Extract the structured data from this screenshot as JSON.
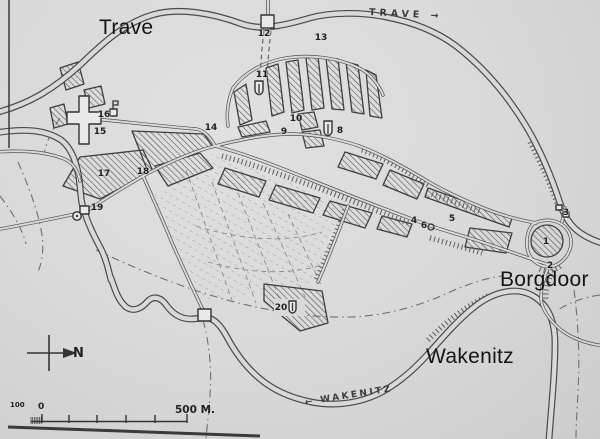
{
  "map": {
    "region_labels": [
      {
        "name": "trave",
        "text": "Trave"
      },
      {
        "name": "borgdoor",
        "text": "Borgdoor"
      },
      {
        "name": "wakenitz",
        "text": "Wakenitz"
      }
    ],
    "river_labels": [
      {
        "name": "trave-river",
        "text": "TRAVE →"
      },
      {
        "name": "wakenitz-river",
        "text": "← WAKENITZ"
      }
    ],
    "compass": {
      "north_label": "N"
    },
    "scale": {
      "hundred_label": "100",
      "zero_label": "0",
      "five_hundred_label": "500 M."
    },
    "markers": [
      {
        "n": "1",
        "x": 546,
        "y": 242
      },
      {
        "n": "2",
        "x": 550,
        "y": 266
      },
      {
        "n": "3",
        "x": 566,
        "y": 213
      },
      {
        "n": "4",
        "x": 414,
        "y": 221
      },
      {
        "n": "5",
        "x": 452,
        "y": 219
      },
      {
        "n": "6",
        "x": 424,
        "y": 226
      },
      {
        "n": "8",
        "x": 340,
        "y": 131
      },
      {
        "n": "9",
        "x": 284,
        "y": 132
      },
      {
        "n": "10",
        "x": 296,
        "y": 119
      },
      {
        "n": "11",
        "x": 262,
        "y": 75
      },
      {
        "n": "12",
        "x": 264,
        "y": 34
      },
      {
        "n": "13",
        "x": 321,
        "y": 38
      },
      {
        "n": "14",
        "x": 211,
        "y": 128
      },
      {
        "n": "15",
        "x": 100,
        "y": 132
      },
      {
        "n": "16",
        "x": 104,
        "y": 115
      },
      {
        "n": "17",
        "x": 104,
        "y": 174
      },
      {
        "n": "18",
        "x": 143,
        "y": 172
      },
      {
        "n": "19",
        "x": 97,
        "y": 208
      },
      {
        "n": "20",
        "x": 281,
        "y": 308
      }
    ],
    "colors": {
      "paper": "#d9d9d9",
      "ink": "#4a4a4a",
      "annotation": "#141414"
    }
  }
}
